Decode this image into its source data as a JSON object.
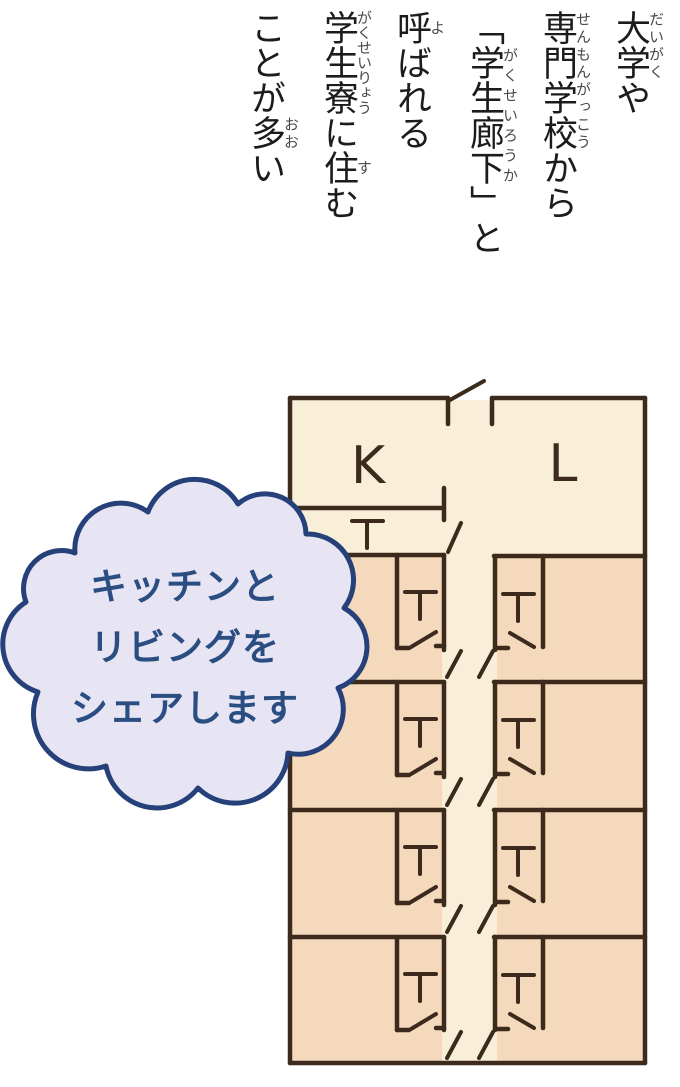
{
  "top_text": {
    "text_color": "#1c1c1c",
    "furigana_color": "#4a4a4a",
    "full_text": "大学や専門学校から「学生廊下」と呼ばれる学生寮に住むことが多い",
    "lines": [
      {
        "segments": [
          {
            "t": "大学",
            "r": "だいがく"
          },
          {
            "t": "や"
          }
        ]
      },
      {
        "segments": [
          {
            "t": "専門学校",
            "r": "せんもんがっこう"
          },
          {
            "t": "から"
          }
        ]
      },
      {
        "segments": [
          {
            "t": "「"
          },
          {
            "t": "学生廊下",
            "r": "がくせいろうか"
          },
          {
            "t": "」と"
          }
        ]
      },
      {
        "segments": [
          {
            "t": "呼",
            "r": "よ"
          },
          {
            "t": "ばれる"
          }
        ]
      },
      {
        "segments": [
          {
            "t": "学生寮",
            "r": "がくせいりょう"
          },
          {
            "t": "に"
          },
          {
            "t": "住",
            "r": "す"
          },
          {
            "t": "む"
          }
        ]
      },
      {
        "segments": [
          {
            "t": "ことが"
          },
          {
            "t": "多",
            "r": "おお"
          },
          {
            "t": "い"
          }
        ]
      }
    ]
  },
  "speech_bubble": {
    "lines": [
      "キッチンと",
      "リビングを",
      "シェアします"
    ],
    "fill": "#e7e4f3",
    "outline": "#26407a",
    "outline_width": 5,
    "text_color": "#2a4d82",
    "path": "M75,553 A46,46 0 0 1 148,512 A50,50 0 0 1 238,504 A41,41 0 0 1 306,534 A46,46 0 0 1 344,608 A44,44 0 0 1 338,688 A45,45 0 0 1 288,753 A53,53 0 0 1 198,788 A52,52 0 0 1 106,766 A55,55 0 0 1 38,692 A50,50 0 0 1 26,602 A38,38 0 0 1 75,553 Z"
  },
  "floor_plan": {
    "colors": {
      "wall": "#3c2b1d",
      "hall_floor": "#f9efd9",
      "room_floor": "#f4d9bd"
    },
    "wall_width": 4.5,
    "door_width": 4,
    "fixture_symbol": "T",
    "labels": [
      {
        "text": "K",
        "x": 368,
        "y": 483,
        "size": 52,
        "name": "kitchen-label"
      },
      {
        "text": "L",
        "x": 563,
        "y": 481,
        "size": 52,
        "name": "living-label"
      }
    ],
    "floors": [
      {
        "x": 292,
        "y": 400,
        "w": 351,
        "h": 661,
        "type": "hall"
      },
      {
        "x": 292,
        "y": 557,
        "w": 150,
        "h": 123,
        "type": "room"
      },
      {
        "x": 292,
        "y": 684,
        "w": 150,
        "h": 124,
        "type": "room"
      },
      {
        "x": 292,
        "y": 812,
        "w": 150,
        "h": 123,
        "type": "room"
      },
      {
        "x": 292,
        "y": 939,
        "w": 150,
        "h": 122,
        "type": "room"
      },
      {
        "x": 497,
        "y": 558,
        "w": 146,
        "h": 122,
        "type": "room"
      },
      {
        "x": 497,
        "y": 684,
        "w": 146,
        "h": 124,
        "type": "room"
      },
      {
        "x": 497,
        "y": 812,
        "w": 146,
        "h": 123,
        "type": "room"
      },
      {
        "x": 497,
        "y": 939,
        "w": 146,
        "h": 122,
        "type": "room"
      }
    ],
    "walls": [
      [
        290,
        398,
        448,
        398
      ],
      [
        492,
        398,
        645,
        398
      ],
      [
        290,
        398,
        290,
        1063
      ],
      [
        645,
        398,
        645,
        1063
      ],
      [
        290,
        1063,
        645,
        1063
      ],
      [
        448,
        398,
        448,
        424
      ],
      [
        492,
        398,
        492,
        424
      ],
      [
        290,
        508,
        444,
        508
      ],
      [
        444,
        488,
        444,
        520
      ],
      [
        290,
        555,
        444,
        555
      ],
      [
        290,
        682,
        444,
        682
      ],
      [
        290,
        810,
        444,
        810
      ],
      [
        290,
        937,
        444,
        937
      ],
      [
        494,
        556,
        645,
        556
      ],
      [
        494,
        682,
        645,
        682
      ],
      [
        494,
        810,
        645,
        810
      ],
      [
        494,
        937,
        645,
        937
      ],
      [
        444,
        555,
        444,
        650
      ],
      [
        444,
        682,
        444,
        777
      ],
      [
        444,
        810,
        444,
        905
      ],
      [
        444,
        937,
        444,
        1030
      ],
      [
        495,
        556,
        495,
        650
      ],
      [
        495,
        682,
        495,
        777
      ],
      [
        495,
        810,
        495,
        905
      ],
      [
        495,
        937,
        495,
        1030
      ],
      [
        397,
        555,
        397,
        648
      ],
      [
        397,
        648,
        409,
        648
      ],
      [
        436,
        646,
        444,
        646
      ],
      [
        397,
        682,
        397,
        775
      ],
      [
        397,
        775,
        409,
        775
      ],
      [
        436,
        773,
        444,
        773
      ],
      [
        397,
        810,
        397,
        903
      ],
      [
        397,
        903,
        409,
        903
      ],
      [
        436,
        901,
        444,
        901
      ],
      [
        397,
        937,
        397,
        1030
      ],
      [
        397,
        1030,
        409,
        1030
      ],
      [
        436,
        1028,
        444,
        1028
      ],
      [
        543,
        556,
        543,
        647
      ],
      [
        495,
        648,
        508,
        648
      ],
      [
        543,
        682,
        543,
        773
      ],
      [
        495,
        774,
        508,
        774
      ],
      [
        543,
        810,
        543,
        901
      ],
      [
        495,
        902,
        508,
        902
      ],
      [
        543,
        937,
        543,
        1028
      ],
      [
        495,
        1029,
        508,
        1029
      ]
    ],
    "door_leaves": [
      [
        450,
        400,
        484,
        381
      ],
      [
        448,
        552,
        461,
        523
      ],
      [
        447,
        677,
        461,
        651
      ],
      [
        447,
        805,
        461,
        779
      ],
      [
        447,
        932,
        461,
        906
      ],
      [
        447,
        1058,
        461,
        1032
      ],
      [
        479,
        677,
        493,
        651
      ],
      [
        479,
        805,
        493,
        779
      ],
      [
        479,
        932,
        493,
        906
      ],
      [
        479,
        1058,
        493,
        1032
      ],
      [
        411,
        647,
        436,
        632
      ],
      [
        411,
        774,
        436,
        759
      ],
      [
        411,
        902,
        436,
        887
      ],
      [
        411,
        1029,
        436,
        1014
      ],
      [
        510,
        633,
        534,
        647
      ],
      [
        510,
        759,
        534,
        773
      ],
      [
        510,
        887,
        534,
        901
      ],
      [
        510,
        1014,
        534,
        1028
      ]
    ],
    "fixtures": [
      {
        "bar": [
          352,
          521,
          383,
          521
        ],
        "stem": [
          367,
          521,
          367,
          548
        ]
      },
      {
        "bar": [
          405,
          592,
          436,
          592
        ],
        "stem": [
          420,
          592,
          420,
          619
        ]
      },
      {
        "bar": [
          405,
          719,
          436,
          719
        ],
        "stem": [
          420,
          719,
          420,
          746
        ]
      },
      {
        "bar": [
          405,
          847,
          436,
          847
        ],
        "stem": [
          420,
          847,
          420,
          874
        ]
      },
      {
        "bar": [
          405,
          974,
          436,
          974
        ],
        "stem": [
          420,
          974,
          420,
          1001
        ]
      },
      {
        "bar": [
          503,
          594,
          534,
          594
        ],
        "stem": [
          518,
          594,
          518,
          621
        ]
      },
      {
        "bar": [
          503,
          720,
          534,
          720
        ],
        "stem": [
          518,
          720,
          518,
          747
        ]
      },
      {
        "bar": [
          503,
          848,
          534,
          848
        ],
        "stem": [
          518,
          848,
          518,
          875
        ]
      },
      {
        "bar": [
          503,
          975,
          534,
          975
        ],
        "stem": [
          518,
          975,
          518,
          1002
        ]
      }
    ]
  }
}
